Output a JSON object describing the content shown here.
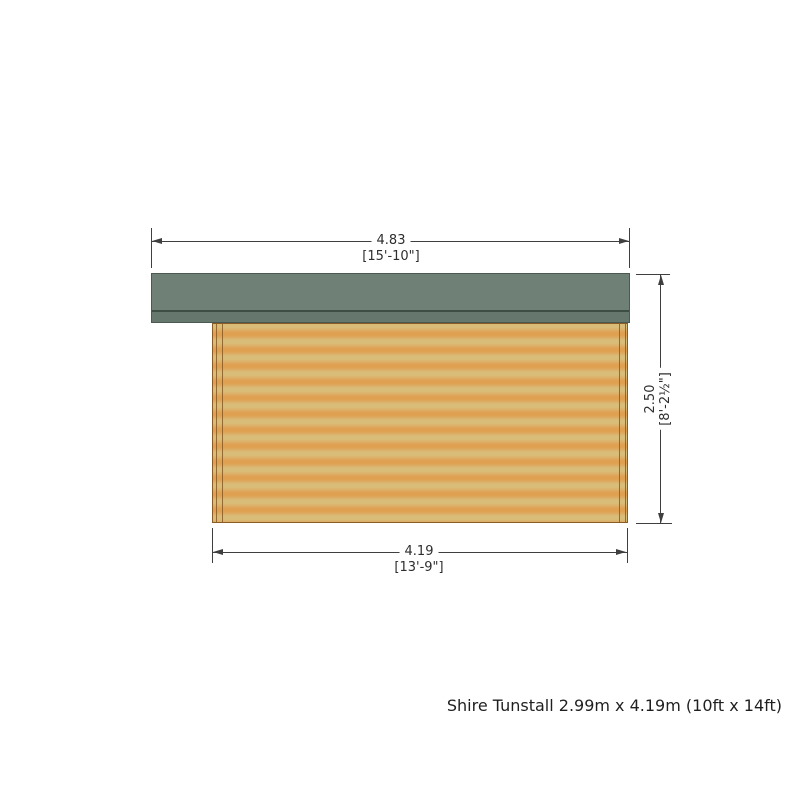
{
  "drawing": {
    "title": "Side elevation dimension drawing",
    "top_dimension": {
      "value": "4.83",
      "imperial": "[15'-10\"]"
    },
    "height_dimension": {
      "value": "2.50",
      "imperial": "[8'-2½\"]"
    },
    "bottom_dimension": {
      "value": "4.19",
      "imperial": "[13'-9\"]"
    },
    "caption": "Shire Tunstall 2.99m x 4.19m (10ft x 14ft)",
    "colors": {
      "roof": "#6f8177",
      "roof_edge": "#66786d",
      "roof_line": "#3e4e45",
      "wall_light": "#d9bc78",
      "wall_dark": "#dfa052",
      "wall_border": "#8a5b25",
      "dimension": "#3f3f3f"
    }
  }
}
